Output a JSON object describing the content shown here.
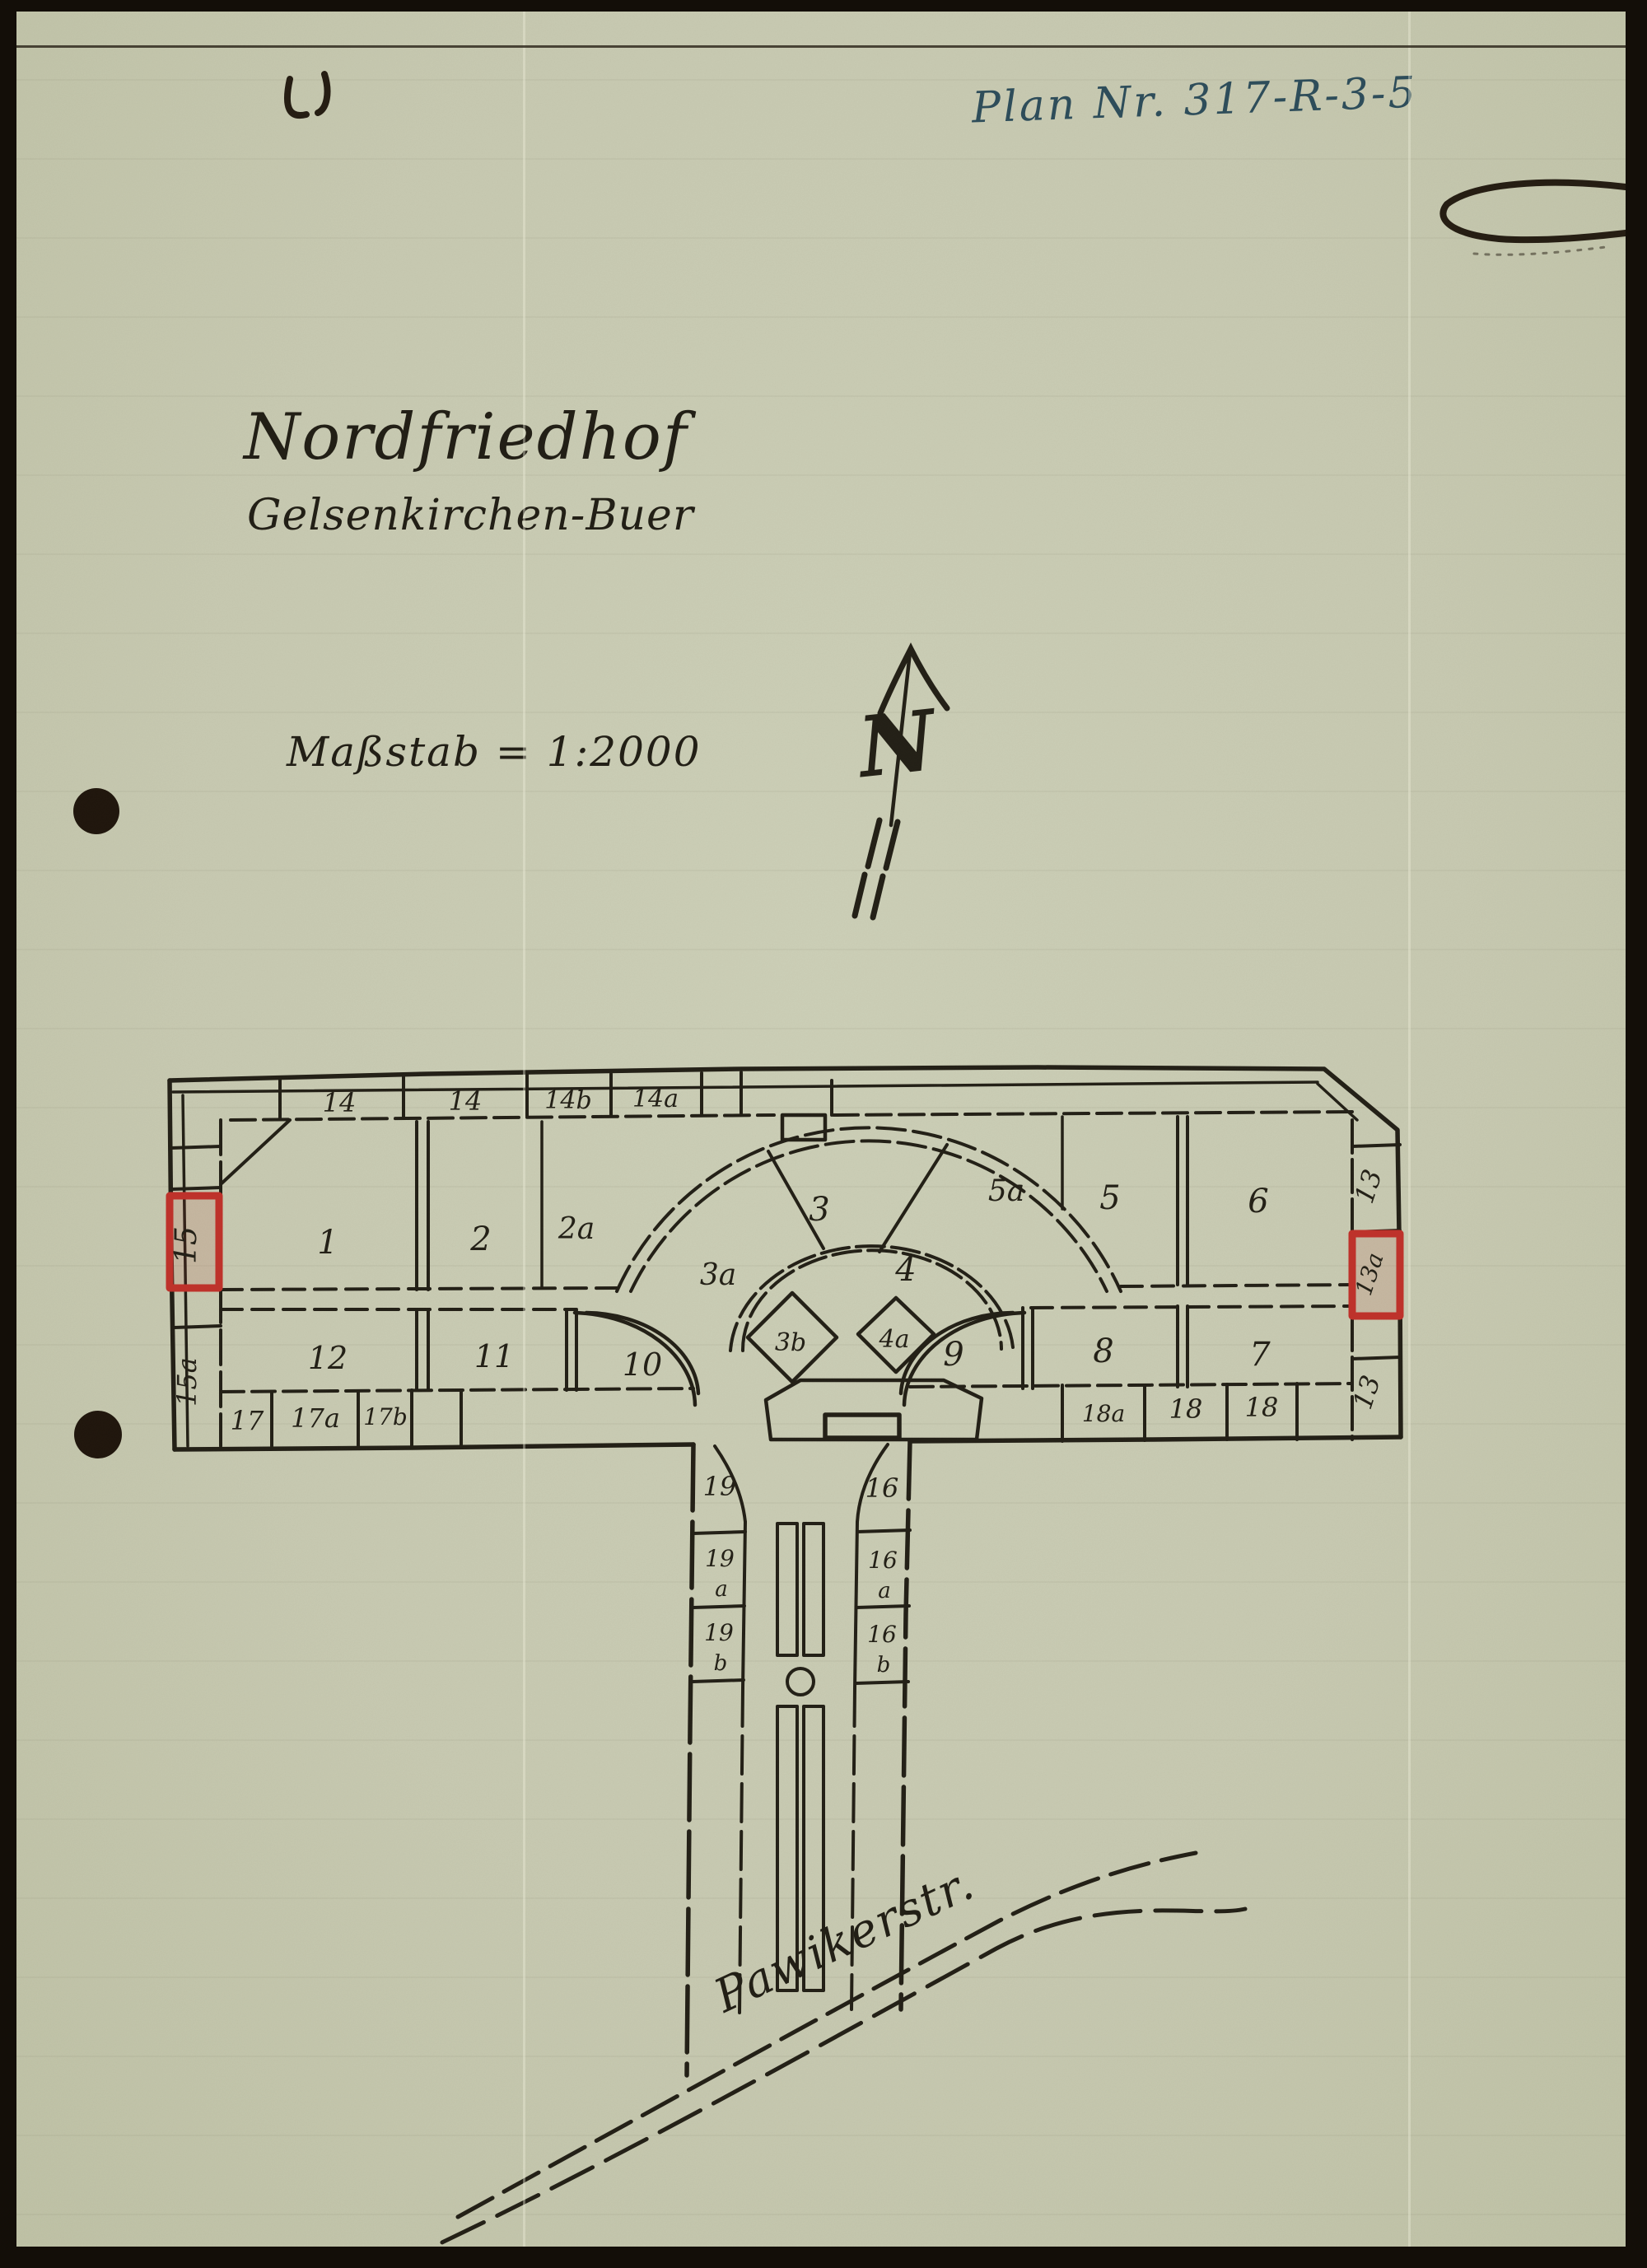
{
  "page": {
    "plan_number": "Plan Nr. 317-R-3-5",
    "title_line1": "Nordfriedhof",
    "title_line2": "Gelsenkirchen-Buer",
    "scale_label": "Maßstab = 1:2000",
    "compass_letter": "N",
    "street_label": "Pawikerstr."
  },
  "plan": {
    "top_row": [
      "14",
      "14",
      "14b",
      "14a"
    ],
    "upper_row": [
      "1",
      "2",
      "2a"
    ],
    "fan_sections": [
      "3a",
      "3",
      "4"
    ],
    "upper_right_row": [
      "5a",
      "5",
      "6"
    ],
    "lower_row": [
      "12",
      "11",
      "10",
      "9",
      "8",
      "7"
    ],
    "diamond_sections": [
      "3b",
      "4a"
    ],
    "left_edge_sections": [
      "15",
      "15a"
    ],
    "right_edge_sections": [
      "13",
      "13a",
      "13"
    ],
    "bottom_row_left": [
      "17",
      "17a",
      "17b"
    ],
    "bottom_row_right": [
      "18a",
      "18",
      "18"
    ],
    "corridor_left": [
      {
        "num": "19",
        "suffix": ""
      },
      {
        "num": "19",
        "suffix": "a"
      },
      {
        "num": "19",
        "suffix": "b"
      }
    ],
    "corridor_right": [
      {
        "num": "16",
        "suffix": ""
      },
      {
        "num": "16",
        "suffix": "a"
      },
      {
        "num": "16",
        "suffix": "b"
      }
    ],
    "highlighted_sections": [
      "15",
      "13a"
    ]
  },
  "colors": {
    "paper": "#c8cab2",
    "ink": "#221f16",
    "highlight_red": "#c0312a",
    "annotation_blue": "#2e4d5a"
  }
}
